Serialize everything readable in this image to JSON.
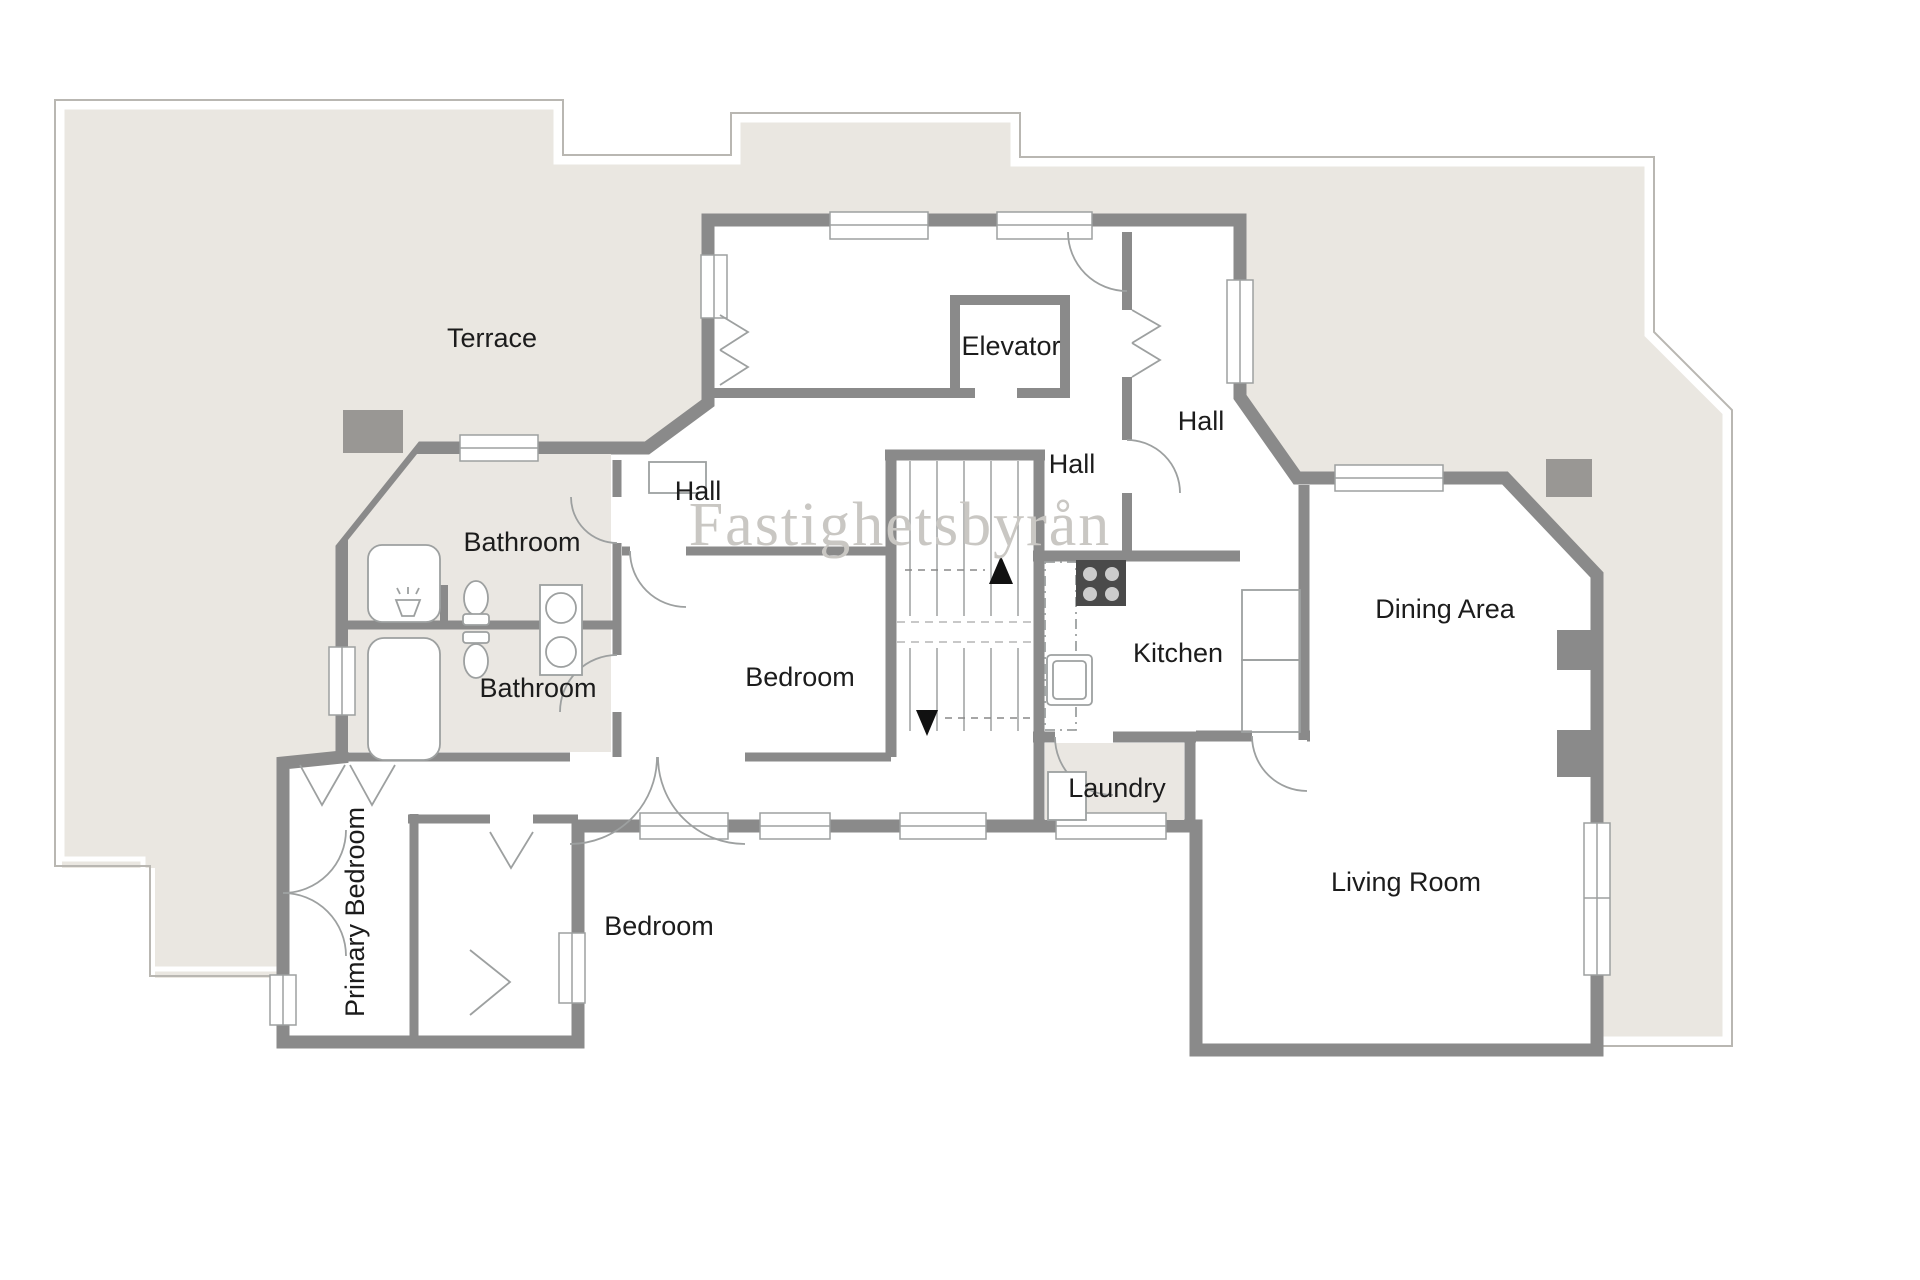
{
  "watermark": "Fastighetsbyrån",
  "rooms": {
    "terrace": {
      "label": "Terrace"
    },
    "elevator": {
      "label": "Elevator"
    },
    "hall_top_right": {
      "label": "Hall"
    },
    "hall_middle": {
      "label": "Hall"
    },
    "hall_left": {
      "label": "Hall"
    },
    "bathroom_top": {
      "label": "Bathroom"
    },
    "bathroom_bottom": {
      "label": "Bathroom"
    },
    "bedroom_center": {
      "label": "Bedroom"
    },
    "bedroom_bottom": {
      "label": "Bedroom"
    },
    "primary_bedroom": {
      "label": "Primary Bedroom"
    },
    "kitchen": {
      "label": "Kitchen"
    },
    "dining_area": {
      "label": "Dining Area"
    },
    "laundry": {
      "label": "Laundry"
    },
    "living_room": {
      "label": "Living Room"
    }
  },
  "colors": {
    "wall": "#8a8a8a",
    "terrace_fill": "#eae7e1",
    "bath_fill": "#eae7e2",
    "outline": "#b9b7b2",
    "fixture_line": "#9da0a0",
    "label_text": "#1c1c1c",
    "watermark_text": "#c9c7c3",
    "pillar": "#999794",
    "stove": "#4a4a4a"
  }
}
